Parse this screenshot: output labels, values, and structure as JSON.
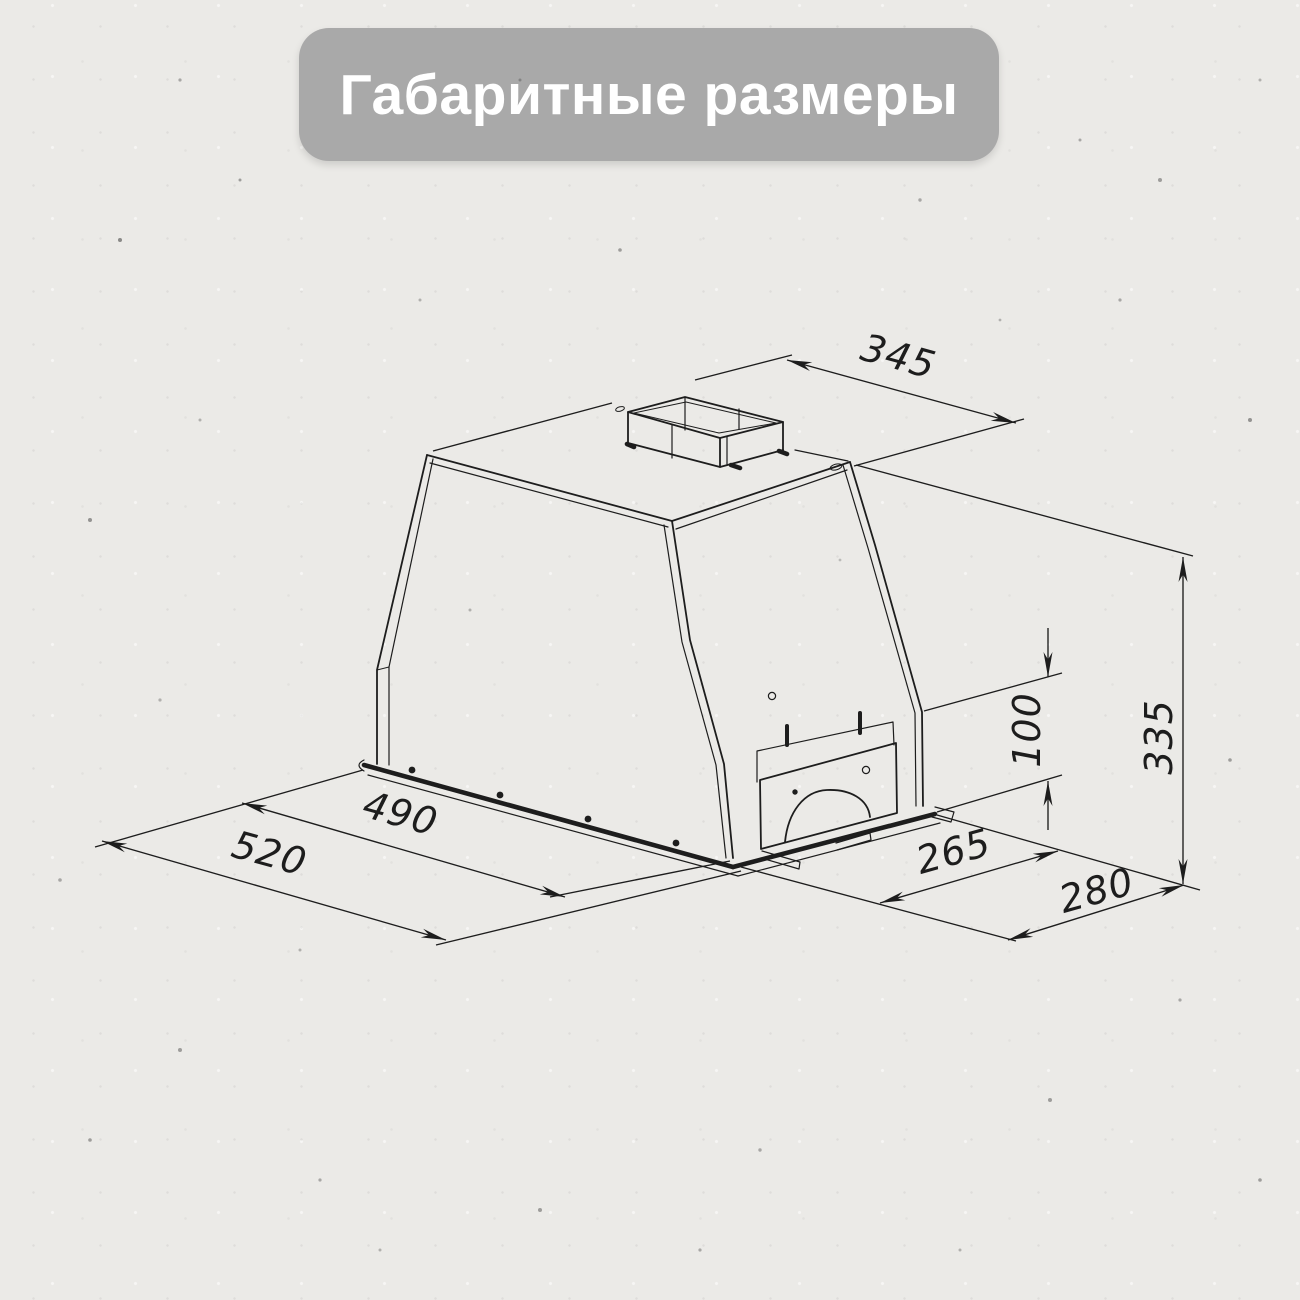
{
  "page": {
    "background_color": "#ebeae7"
  },
  "title_badge": {
    "text": "Габаритные размеры",
    "background_color": "#a9a9a9",
    "text_color": "#ffffff"
  },
  "drawing": {
    "subject": "built-in cooker hood, isometric dimensional drawing",
    "line_color": "#1d1d1d",
    "unit": "mm",
    "dimensions": {
      "top_width": "345",
      "overall_height": "335",
      "lower_section_height": "100",
      "inner_width": "490",
      "overall_width": "520",
      "inner_depth": "265",
      "overall_depth": "280"
    }
  }
}
